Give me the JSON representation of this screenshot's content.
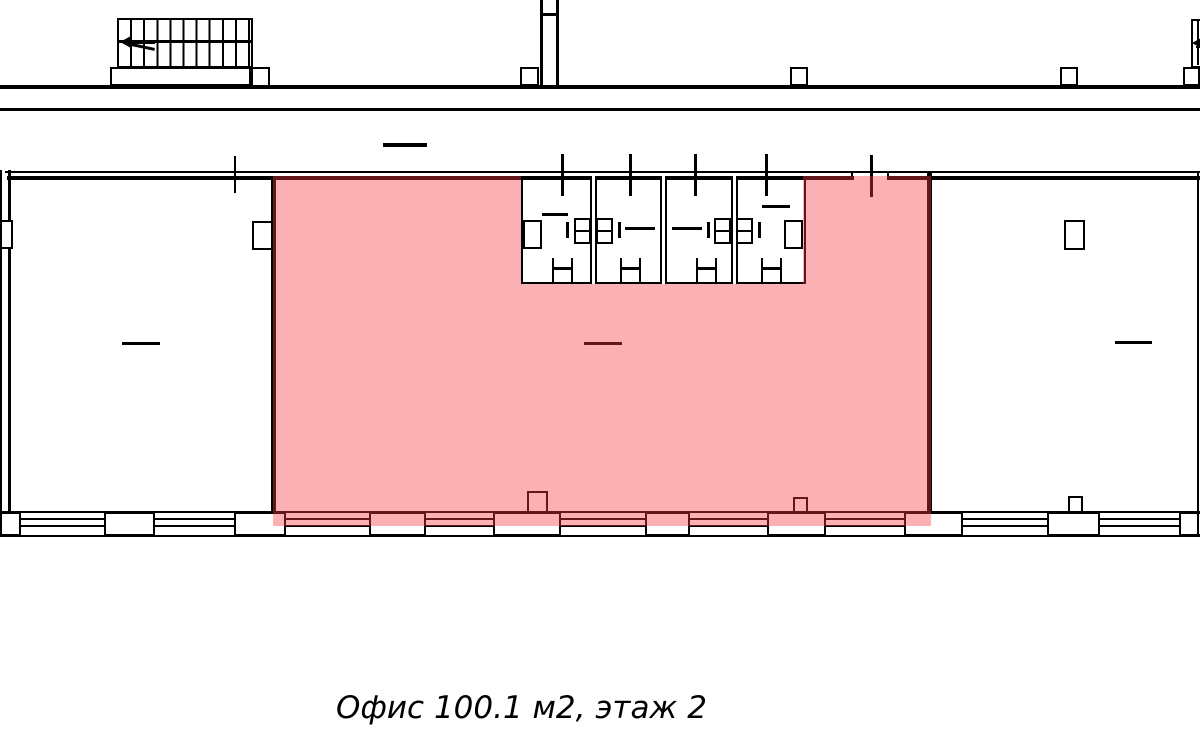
{
  "caption": {
    "text": "Офис 100.1 м2, этаж 2"
  },
  "office": {
    "label": "Офис",
    "area_m2": "100.1",
    "floor": "2"
  },
  "colors": {
    "highlight_fill": "#F63C40",
    "highlight_opacity": "0.40",
    "lines": "#000000",
    "background": "#FFFFFF"
  },
  "plan": {
    "wc_stalls": 4,
    "bottom_windows": 9,
    "staircases": 2
  }
}
